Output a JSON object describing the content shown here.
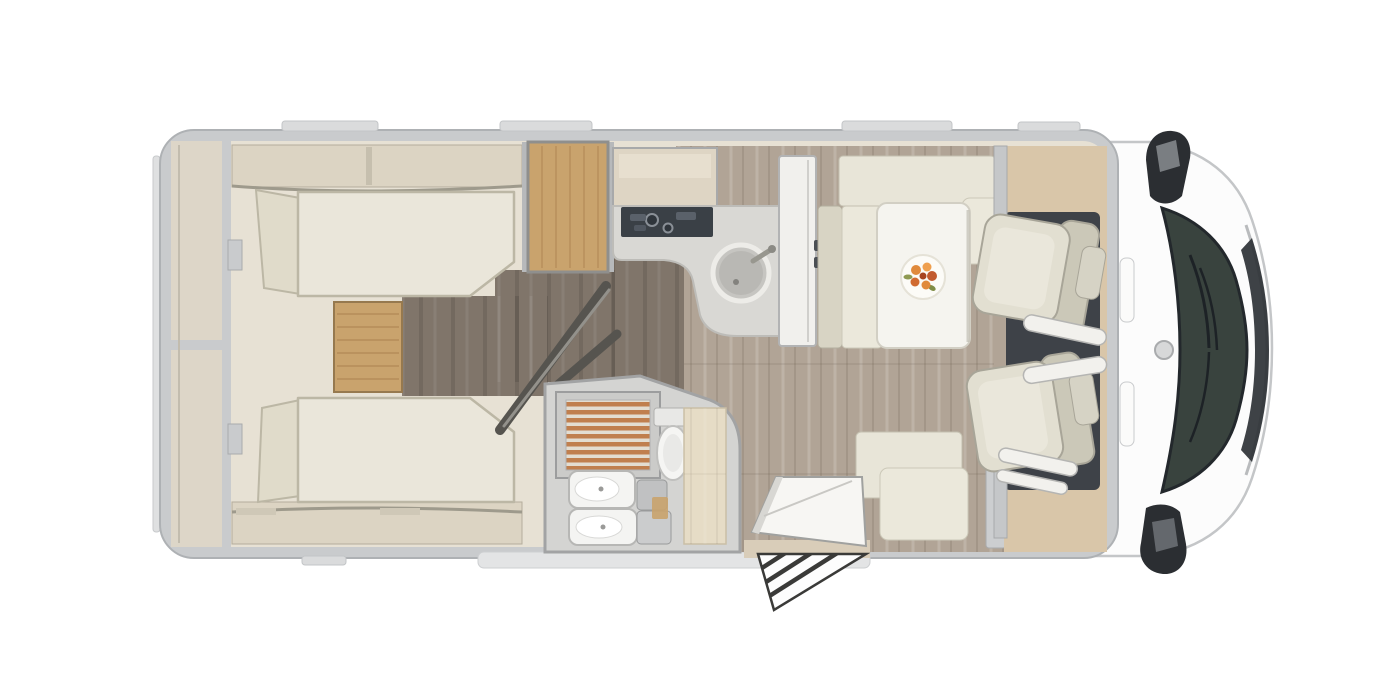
{
  "meta": {
    "type": "motorhome-floorplan",
    "view": "top-down"
  },
  "colors": {
    "bg": "#ffffff",
    "wall_outer": "#c9cbcd",
    "wall_stroke": "#aeb1b4",
    "interior_cream": "#e7e1d4",
    "furniture_beige": "#dcd4c3",
    "mattress": "#eae6da",
    "mattress_edge": "#bcb7a5",
    "cushion": "#e0dbca",
    "wood": "#c9a36d",
    "wood_dark": "#a97f4d",
    "floor_dark": "#80756a",
    "floor_light": "#b1a496",
    "counter": "#d9d8d4",
    "hob": "#3a4046",
    "sink_steel": "#b9b8b4",
    "bath_floor": "#d4d4d2",
    "slat_wood": "#c07f4e",
    "table_white": "#f5f4ef",
    "flower_orange": "#e08a3c",
    "flower_deep": "#c25a2e",
    "leaf_green": "#8f9a52",
    "seat_light": "#e2dfd1",
    "seat_mid": "#cbc8b8",
    "seat_edge": "#a8a598",
    "cab_floor": "#3e4248",
    "cab_tan": "#d9c6a9",
    "cowl_white": "#fcfcfc",
    "windshield": "#39433e",
    "dark_trim": "#23282c",
    "mirror_dark": "#2b2e32",
    "door_panel": "#56544f",
    "step_stripe": "#3a3a38"
  },
  "rooms": {
    "rear_garage": {
      "label": "Rear garage storage"
    },
    "bedroom": {
      "label": "Rear bedroom with twin single beds and step"
    },
    "wardrobe": {
      "label": "Wardrobe"
    },
    "kitchen": {
      "label": "Kitchen with hob, sink and overhead locker"
    },
    "fridge": {
      "label": "Tall fridge cabinet"
    },
    "bathroom": {
      "label": "Bathroom with shower, toilet and washbasins"
    },
    "dinette": {
      "label": "L-shaped dinette with table"
    },
    "cab": {
      "label": "Driver cab with two swivel seats"
    },
    "entrance": {
      "label": "Entrance door with folding step"
    },
    "front": {
      "label": "Cab front with windscreen and mirrors"
    }
  }
}
